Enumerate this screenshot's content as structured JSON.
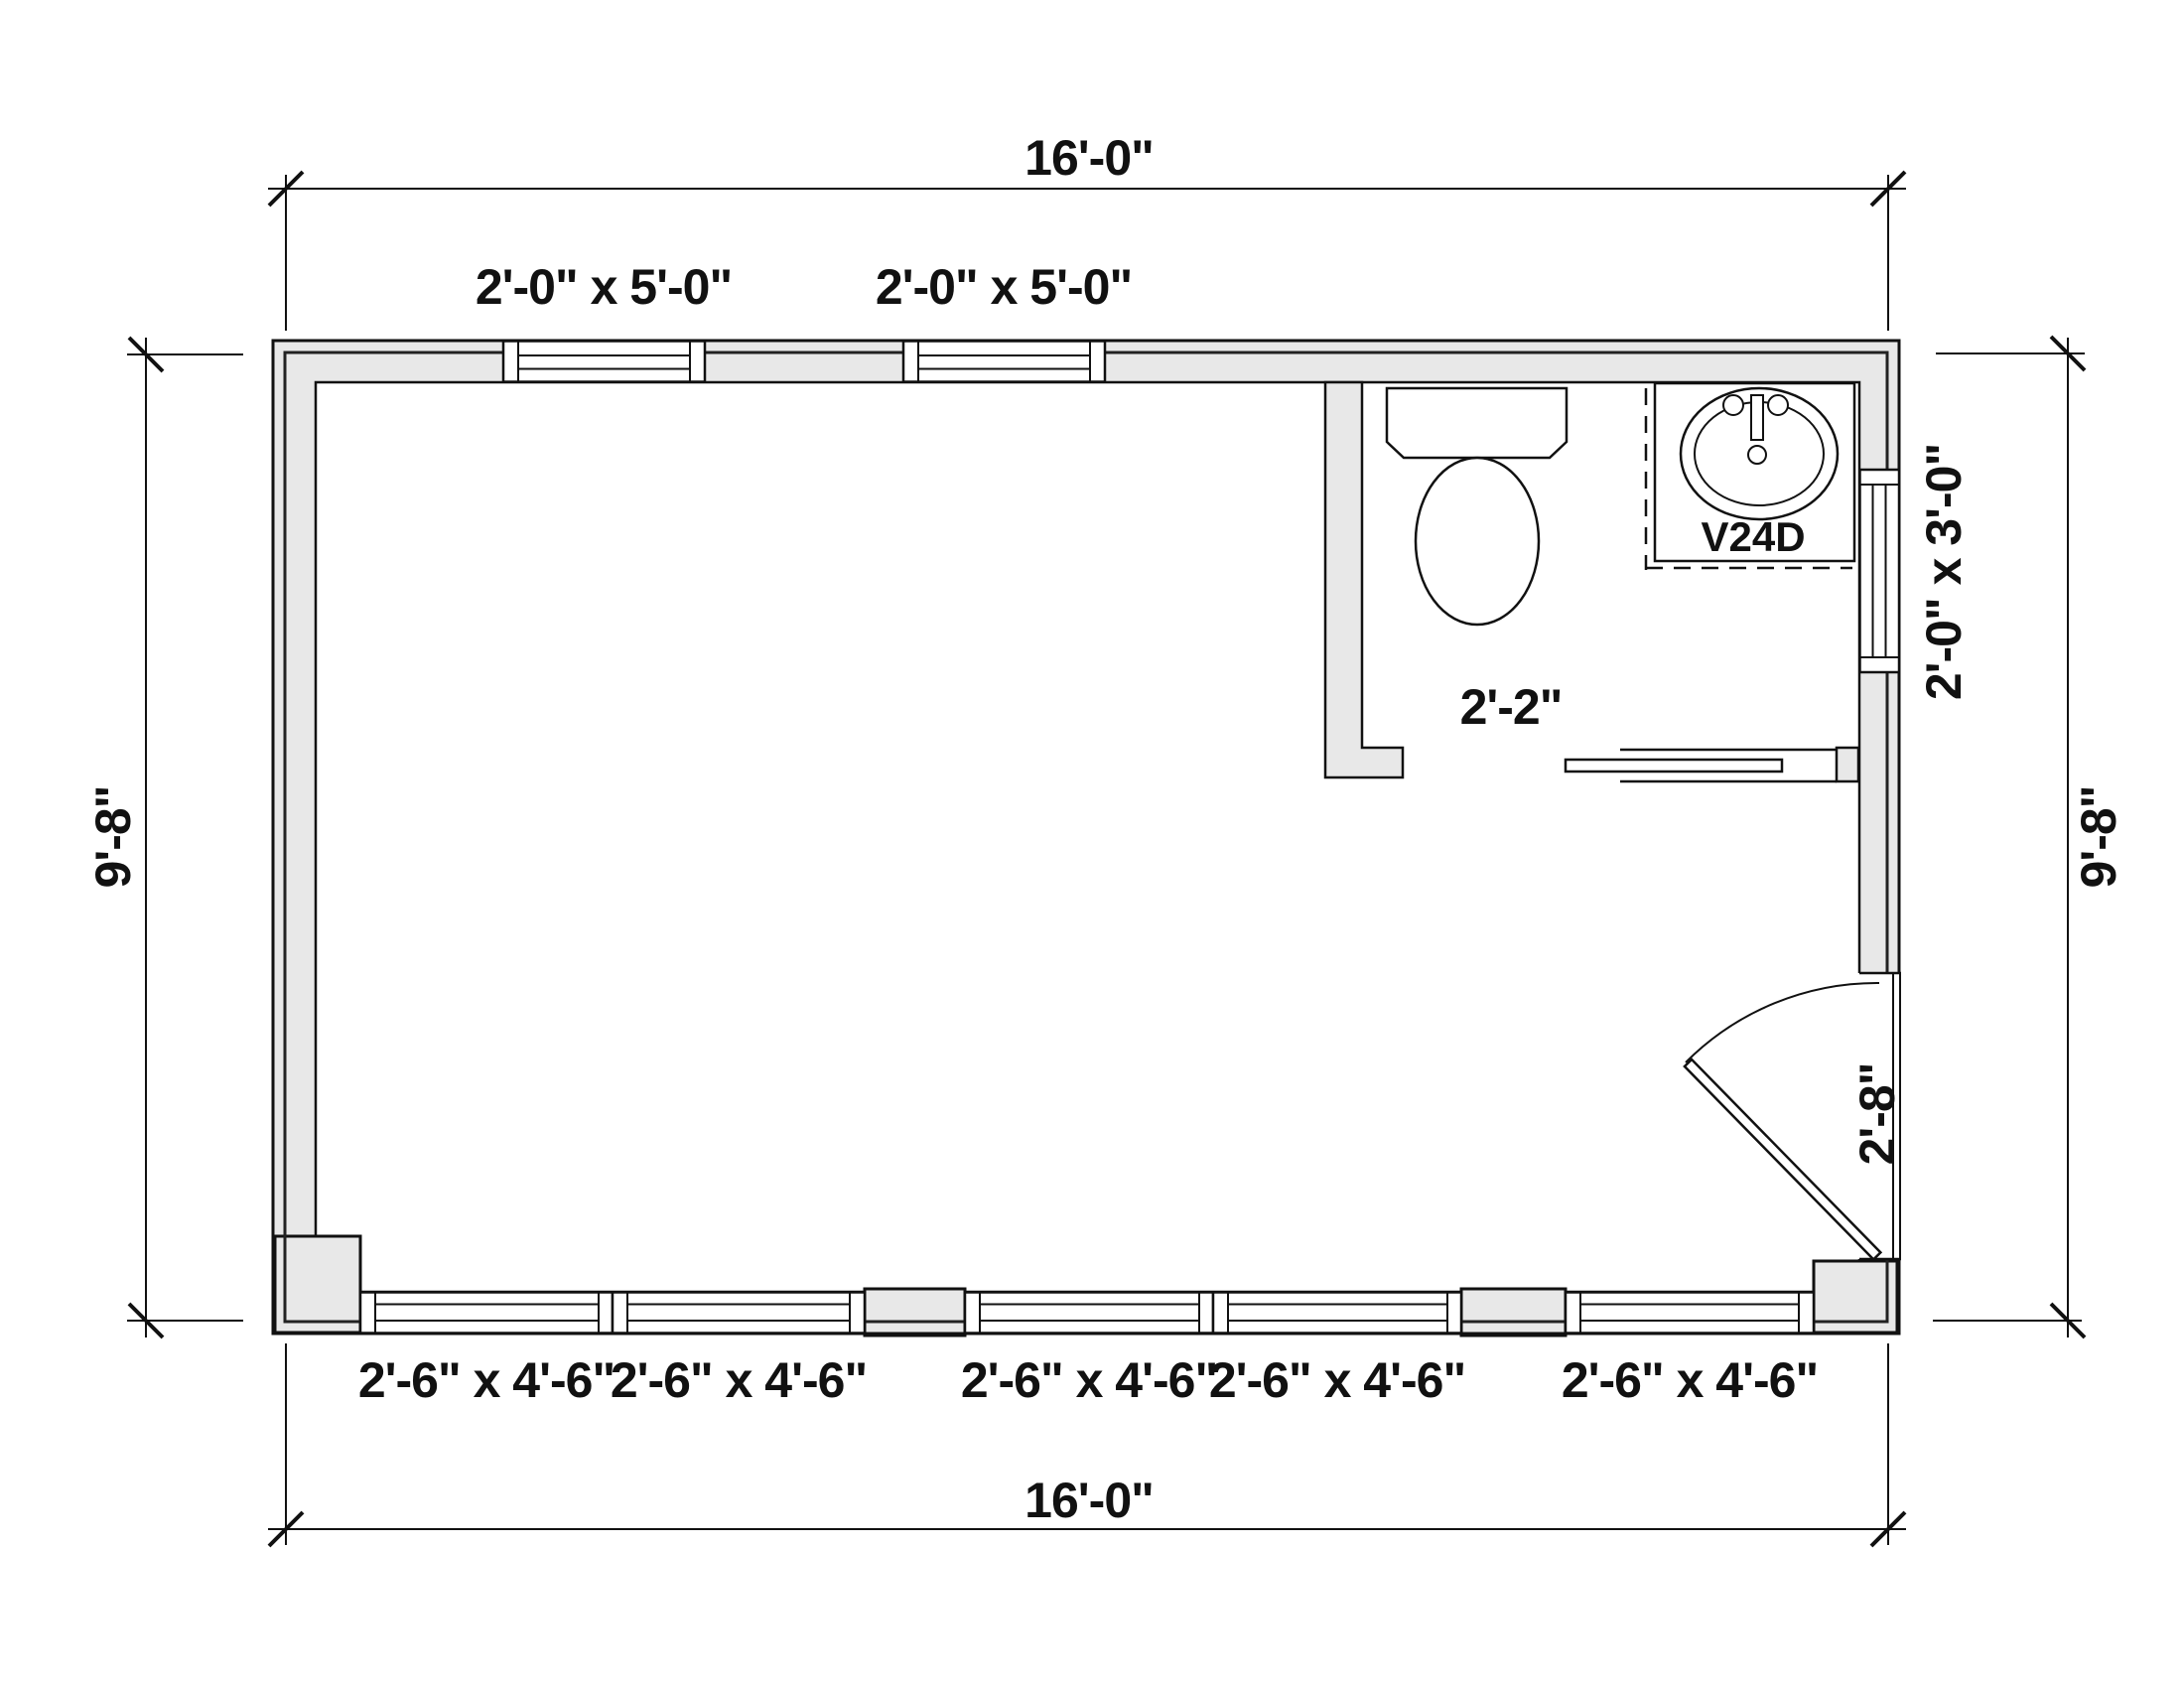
{
  "plan": {
    "dimensions": {
      "top": "16'-0\"",
      "bottom": "16'-0\"",
      "left": "9'-8\"",
      "right": "9'-8\""
    },
    "windows": {
      "top": [
        "2'-0\" x 5'-0\"",
        "2'-0\" x 5'-0\""
      ],
      "bottom": [
        "2'-6\" x 4'-6\"",
        "2'-6\" x 4'-6\"",
        "2'-6\" x 4'-6\"",
        "2'-6\" x 4'-6\"",
        "2'-6\" x 4'-6\""
      ],
      "right": "2'-0\" x 3'-0\""
    },
    "doors": {
      "entry_width": "2'-8\"",
      "bath_opening_width": "2'-2\""
    },
    "fixtures": {
      "vanity_model": "V24D"
    },
    "colors": {
      "wall_fill": "#e8e8e8",
      "line": "#111111",
      "text": "#111111"
    }
  }
}
